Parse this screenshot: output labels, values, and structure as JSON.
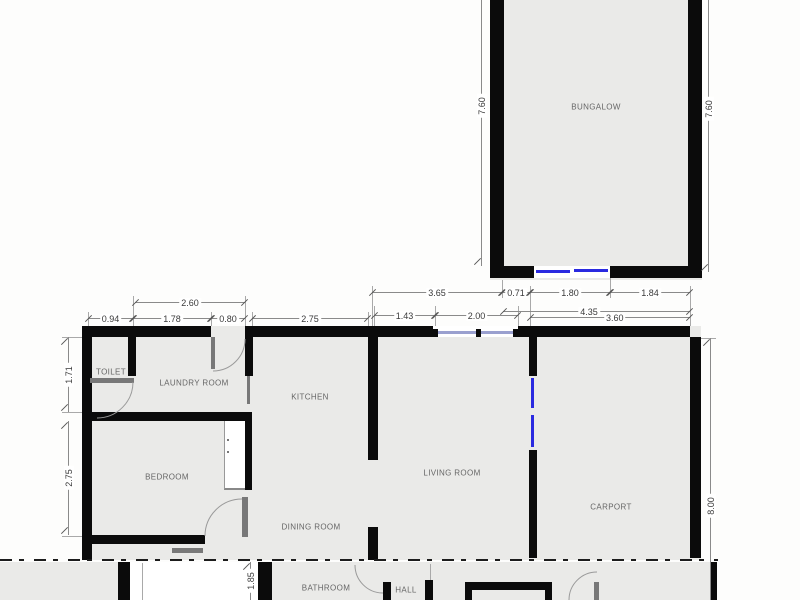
{
  "colors": {
    "background": "#fdfdfc",
    "room_fill": "#eaeae8",
    "wall": "#0b0b0b",
    "window_blue": "#2a2ae0",
    "window_pane": "#9aa0cf",
    "door_gray": "#787878",
    "dim_line": "#8a8a8a",
    "dim_text": "#3a3a3a",
    "room_label": "#666666"
  },
  "rooms": {
    "bungalow": "BUNGALOW",
    "toilet": "TOILET",
    "laundry": "LAUNDRY ROOM",
    "kitchen": "KITCHEN",
    "bedroom": "BEDROOM",
    "dining": "DINING ROOM",
    "living": "LIVING ROOM",
    "carport": "CARPORT",
    "bathroom": "BATHROOM",
    "hall": "HALL"
  },
  "dimensions": {
    "bungalow_height_left": "7.60",
    "bungalow_height_right": "7.60",
    "bungalow_bottom_left": "0.71",
    "bungalow_door": "1.80",
    "bungalow_bottom_right": "1.84",
    "laundry_total_width": "2.60",
    "toilet_width": "0.94",
    "laundry_width": "1.78",
    "laundry_door": "0.80",
    "kitchen_width": "2.75",
    "kitchen_living_span": "3.65",
    "living_wall_seg": "1.43",
    "living_window": "2.00",
    "carport_span_a": "4.35",
    "carport_width": "3.60",
    "toilet_height": "1.71",
    "bedroom_height": "2.75",
    "carport_depth": "8.00",
    "stair_depth": "1.85"
  }
}
